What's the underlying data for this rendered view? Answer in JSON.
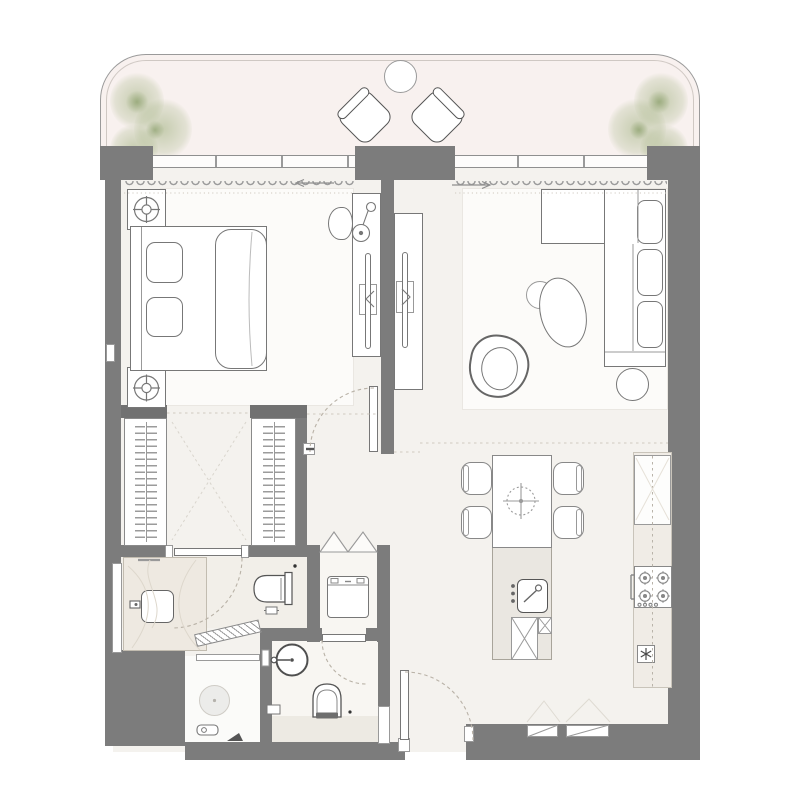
{
  "document": {
    "kind": "architectural-floor-plan-apartment",
    "visible_text": "none"
  },
  "canvas": {
    "width": 800,
    "height": 800,
    "background": "#ffffff"
  },
  "colors": {
    "wall": "#7c7c7c",
    "wall_dark": "#717171",
    "line": "#777777",
    "line_light": "#9a9a9a",
    "dash": "#b9b2a7",
    "floor": "#f4f2ee",
    "rug": "#fcfbf9",
    "bath_floor": "#f2efe9",
    "bath_band": "#edeae3",
    "counter": "#f0ece6",
    "island": "#eae7e1",
    "vanity": "#eee9e1",
    "balcony": "#f8f1ef",
    "plant_green": "#94a870",
    "glass": "#8f8f8f"
  },
  "legend": {
    "balcony": {
      "label": "balcony-terrace",
      "items": [
        "corner-plant",
        "corner-plant",
        "lounge-chair",
        "lounge-chair",
        "round-side-table",
        "glass-railing",
        "sliding-window",
        "curtains",
        "slide-direction-arrows"
      ]
    },
    "bedroom": {
      "label": "bedroom",
      "items": [
        "double-bed",
        "headboard",
        "pillows",
        "duvet",
        "nightstand-with-downlight",
        "nightstand-with-downlight",
        "dresser-console",
        "table-lamp",
        "tv-panel",
        "desk-chair",
        "rug",
        "hinged-door"
      ]
    },
    "living_room": {
      "label": "living-room",
      "items": [
        "l-shaped-sofa",
        "chaise-section",
        "seat-cushions",
        "oval-coffee-table",
        "small-round-table",
        "organic-armchair",
        "round-side-table",
        "tv-console",
        "tv-panel",
        "rug"
      ]
    },
    "dressing_corridor": {
      "label": "walk-in-closet",
      "items": [
        "wardrobe-hanger-unit",
        "wardrobe-hanger-unit",
        "open-front-dashed-x"
      ]
    },
    "bathroom_1": {
      "label": "bathroom-1",
      "items": [
        "vanity-counter",
        "rectangular-sink",
        "faucet",
        "wall-hung-toilet",
        "paper-holder",
        "hinged-door",
        "window-slit"
      ]
    },
    "shower_room": {
      "label": "shower-room",
      "items": [
        "glass-pivot-door",
        "floor-drain",
        "shower-valve",
        "floor-wedge"
      ]
    },
    "bathroom_2": {
      "label": "bathroom-2",
      "items": [
        "round-basin",
        "toilet",
        "hand-spray",
        "ledge-band",
        "hinged-door"
      ]
    },
    "laundry_closet": {
      "label": "laundry-closet",
      "items": [
        "washing-machine",
        "bi-fold-doors"
      ]
    },
    "kitchen": {
      "label": "kitchen-dining",
      "items": [
        "island",
        "dining-table",
        "dining-chair",
        "dining-chair",
        "dining-chair",
        "dining-chair",
        "pendant-light",
        "prep-sink",
        "dishwasher-x",
        "counter-run",
        "tall-unit",
        "gas-cooktop-4-burner",
        "oven-handle",
        "snowflake-appliance-symbol"
      ]
    },
    "entry": {
      "label": "entry",
      "items": [
        "entry-door",
        "door-swing-arc",
        "wall-niches"
      ]
    }
  }
}
